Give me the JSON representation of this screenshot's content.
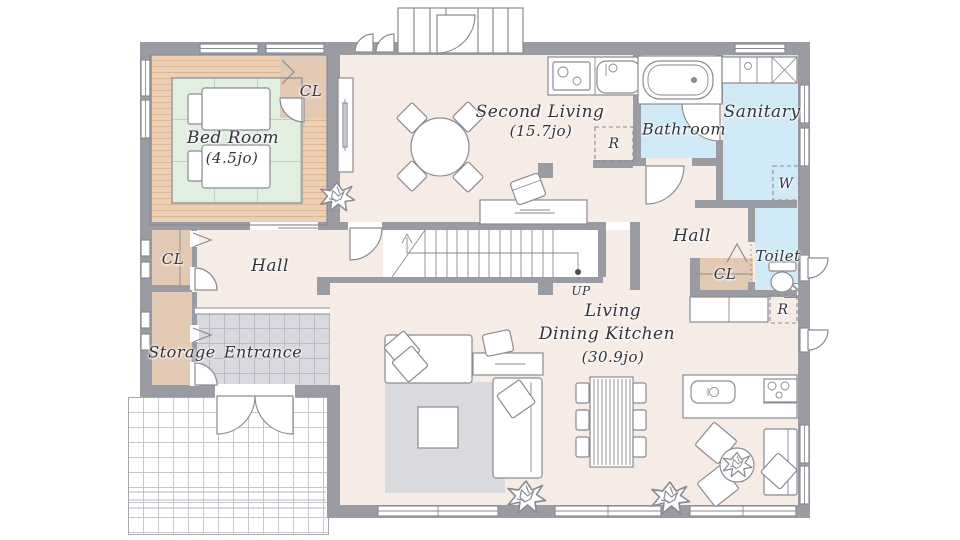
{
  "rooms": {
    "bedroom": {
      "name": "Bed Room",
      "size": "(4.5jo)"
    },
    "bedroom_closet": "CL",
    "second_living": {
      "name": "Second Living",
      "size": "(15.7jo)"
    },
    "bathroom": "Bathroom",
    "sanitary": "Sanitary",
    "hall_right": "Hall",
    "toilet": "Toilet",
    "closet_right": "CL",
    "hall_left": "Hall",
    "closet_left": "CL",
    "storage": "Storage",
    "entrance": "Entrance",
    "ldk": {
      "line1": "Living",
      "line2": "Dining Kitchen",
      "size": "(30.9jo)"
    }
  },
  "markers": {
    "fridge_upper": "R",
    "washer": "W",
    "fridge_lower": "R",
    "stairs_up": "UP"
  },
  "colors": {
    "wall": "#9b9ba3",
    "floor": "#f7ece5",
    "tatami": "#e0efe0",
    "wood": "#eccfb4",
    "water": "#cfe9f7",
    "closet": "#e2c9b4",
    "tile": "#d8d9de",
    "rug": "#d9dadd"
  }
}
